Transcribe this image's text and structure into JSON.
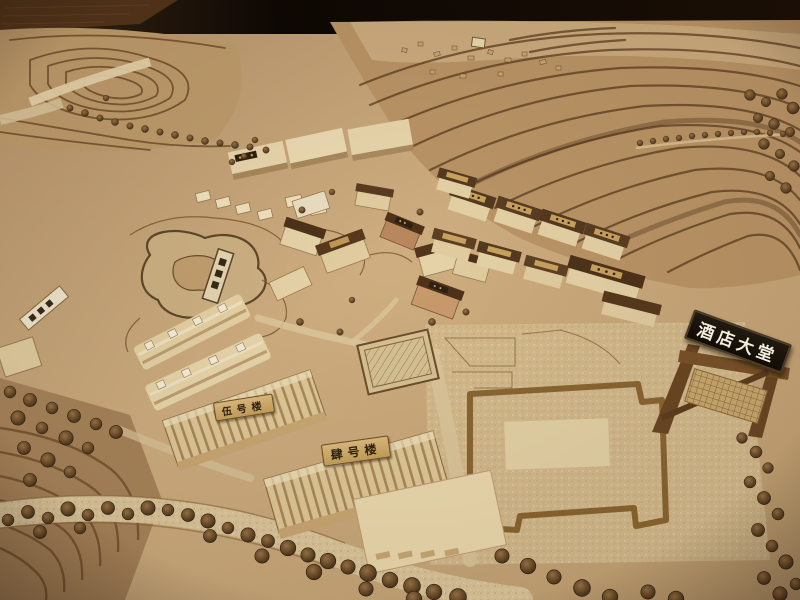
{
  "scene": {
    "signs": {
      "hotel_lobby": "酒店大堂",
      "building_five": "伍号楼",
      "building_four": "肆号楼"
    },
    "palette": {
      "background_dark": "#120a04",
      "table_wood": "#53341a",
      "terrain_tan": "#c9a87a",
      "terrain_light": "#d8bf92",
      "contour_brown": "#5d3e20",
      "building_cream": "#e8d5ac",
      "roof_dark": "#4e3319",
      "tree_brown": "#5f442a",
      "sign_black": "#17110a",
      "sign_text_white": "#f3eedd",
      "plaque_tan": "#c9a666",
      "plaque_text": "#2c2010"
    }
  }
}
